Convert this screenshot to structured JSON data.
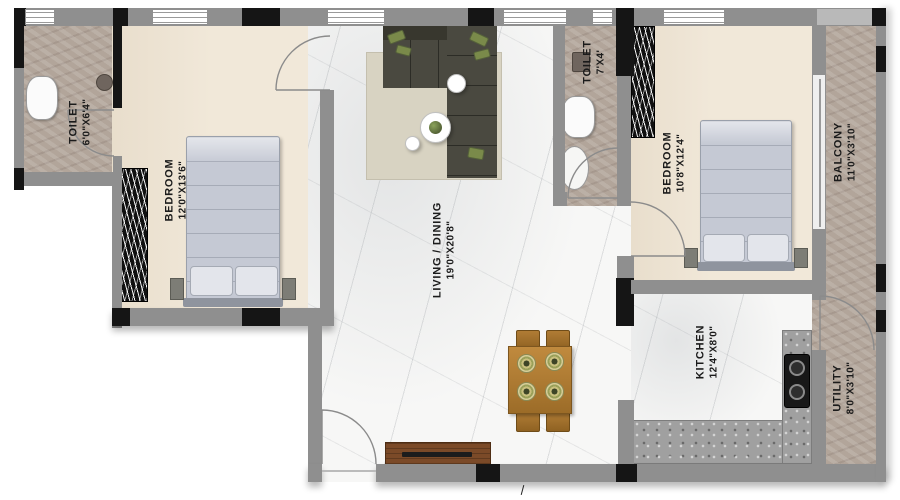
{
  "plan_title": "2BHK apartment floor plan",
  "rooms": [
    {
      "name": "TOILET",
      "dims": "6'0\"X6'4\""
    },
    {
      "name": "BEDROOM",
      "dims": "12'0\"X13'6\""
    },
    {
      "name": "LIVING / DINING",
      "dims": "19'0\"X20'8\""
    },
    {
      "name": "TOILET",
      "dims": "7'X4'"
    },
    {
      "name": "BEDROOM",
      "dims": "10'8\"X12'4\""
    },
    {
      "name": "BALCONY",
      "dims": "11'0\"X3'10\""
    },
    {
      "name": "KITCHEN",
      "dims": "12'4\"X8'0\""
    },
    {
      "name": "UTILITY",
      "dims": "8'0\"X3'10\""
    }
  ],
  "colors": {
    "wall": "#8f8f8f",
    "column": "#151515",
    "bedroom_floor": "#f1e8d9",
    "marble_floor": "#f7f7f6",
    "stone_floor": "#b2a59a",
    "sofa": "#4a4940",
    "bed": "#c5c9d4",
    "rug": "#d8d3c2",
    "wood": "#b5813a",
    "tv_unit": "#7b4a28",
    "counter": "#a0a0a0",
    "label_text": "#1b1b1b"
  }
}
